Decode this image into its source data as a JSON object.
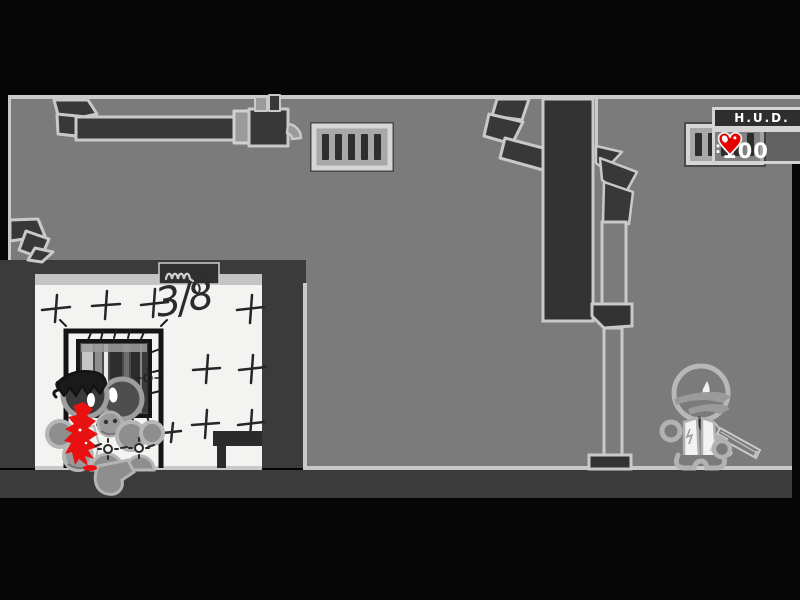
{
  "hud": {
    "title": "H.U.D.",
    "health_separator": ":",
    "health_value": "100",
    "heart_icon": "heart-icon",
    "heart_color": "#e60000"
  },
  "left_room": {
    "note": "3/8"
  },
  "colors": {
    "background": "#060606",
    "play_area": "#7b7b7b",
    "structure_dark": "#3b3b3b",
    "outline_light": "#c9c9c9",
    "room_white": "#f3f3f1",
    "blood_red": "#e81010",
    "hud_border": "#d4d4d4",
    "hud_fill": "#2e2e2e",
    "text_white": "#ffffff"
  }
}
